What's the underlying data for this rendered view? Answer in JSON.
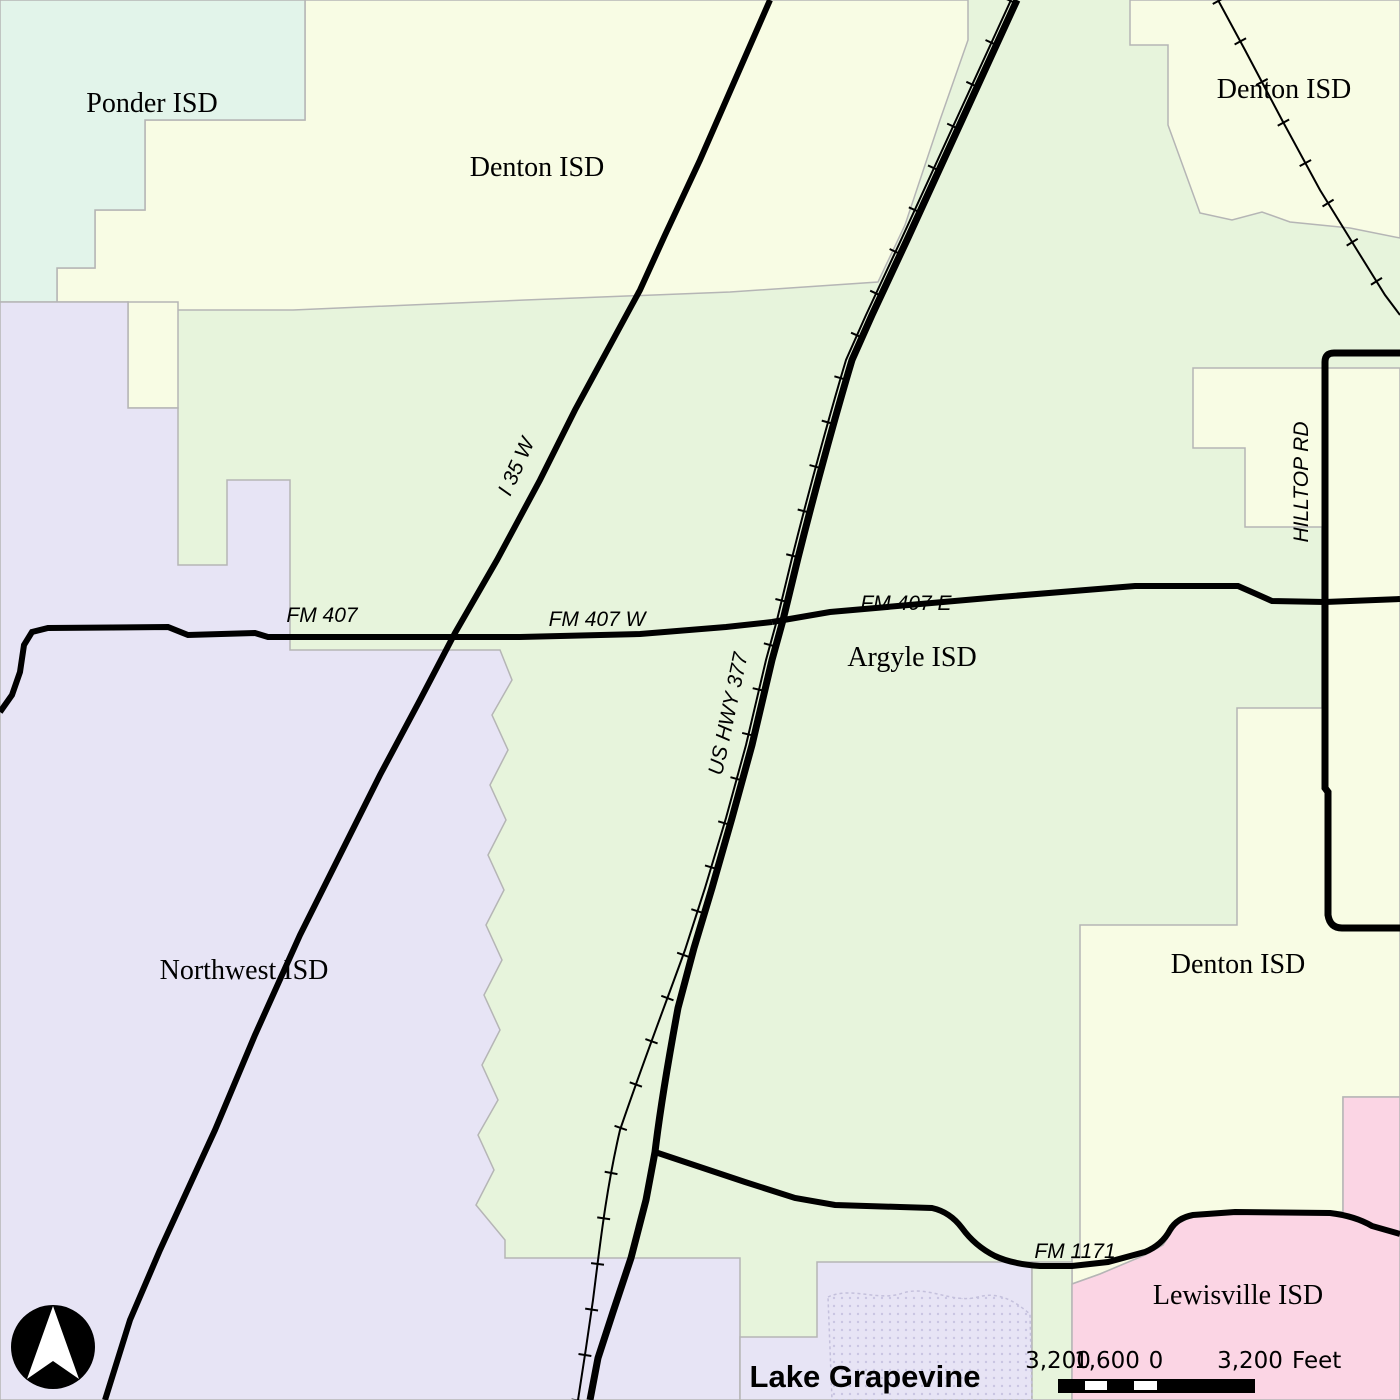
{
  "districts": {
    "ponder": {
      "label": "Ponder ISD",
      "color": "#e2f4ea"
    },
    "denton": {
      "label": "Denton ISD",
      "color": "#f8fce4"
    },
    "argyle": {
      "label": "Argyle ISD",
      "color": "#e7f4dc"
    },
    "northwest": {
      "label": "Northwest ISD",
      "color": "#e7e4f5"
    },
    "lewisville": {
      "label": "Lewisville ISD",
      "color": "#fbd5e4"
    }
  },
  "water": {
    "label": "Lake Grapevine",
    "dot_color": "#c9c5e2",
    "outline_color": "#c4c0dc"
  },
  "roads": {
    "color": "#000000",
    "i35": "I 35 W",
    "us377": "US HWY 377",
    "fm407": "FM 407",
    "fm407w": "FM 407 W",
    "fm407e": "FM 407 E",
    "hilltop": "HILLTOP RD",
    "fm1171": "FM 1171"
  },
  "boundary_color": "#b5b5b5",
  "scalebar": {
    "ticks": [
      "3,200",
      "1,600",
      "0",
      "3,200"
    ],
    "unit": "Feet",
    "bar_color": "#000000",
    "gap_color": "#ffffff"
  },
  "north_arrow": {
    "circle_color": "#000000",
    "arrow_color": "#ffffff"
  }
}
